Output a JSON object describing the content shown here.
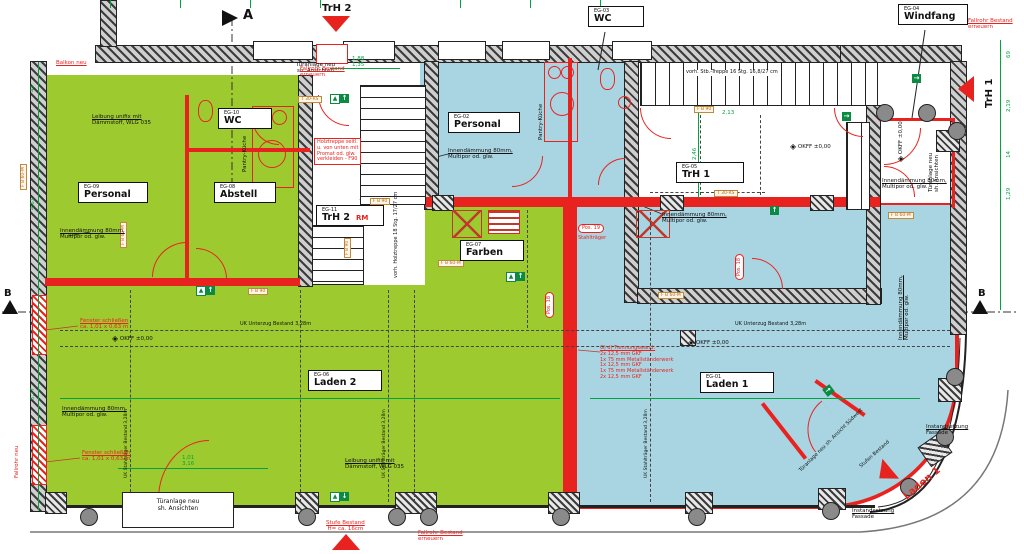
{
  "colors": {
    "green_room": "#9dcb2f",
    "blue_room": "#a9d5e2",
    "new_red": "#e8231f",
    "dim_green": "#00a33d",
    "wall_gray": "#3c3c3c",
    "fire_orange": "#c08a3e",
    "exit_green": "#0a8a43"
  },
  "section": {
    "a": "A",
    "b_left": "B",
    "b_right": "B"
  },
  "arrows": {
    "trh2": "TrH 2",
    "trh1": "TrH 1",
    "laden1": "Laden 1"
  },
  "rooms": {
    "personal_eg09": {
      "id": "EG-09",
      "name": "Personal"
    },
    "wc_eg10": {
      "id": "EG-10",
      "name": "WC"
    },
    "abstell_eg08": {
      "id": "EG-08",
      "name": "Abstell"
    },
    "trh2_eg11": {
      "id": "EG-11",
      "name": "TrH 2",
      "suffix": "RM"
    },
    "personal_eg02": {
      "id": "EG-02",
      "name": "Personal"
    },
    "wc_eg03": {
      "id": "EG-03",
      "name": "WC"
    },
    "windfang_eg04": {
      "id": "EG-04",
      "name": "Windfang"
    },
    "trh1_eg05": {
      "id": "EG-05",
      "name": "TrH 1"
    },
    "farben_eg07": {
      "id": "EG-07",
      "name": "Farben"
    },
    "laden2_eg06": {
      "id": "EG-06",
      "name": "Laden 2"
    },
    "laden1_eg01": {
      "id": "EG-01",
      "name": "Laden 1"
    }
  },
  "ann": {
    "innend": "Innendämmung 80mm,",
    "innend2": "Multipor od. glw.",
    "leibung": "Leibung unifix mit",
    "leibung2": "Dämmstoff, WLG 035",
    "balkon": "Balkon neu",
    "fallrohr": "Fallrohr Bestand",
    "fallrohr2": "erneuern",
    "fallrohr_neu": "Fallrohr neu",
    "fenster": "Fenster schließen",
    "fenster2": "ca. 1,01 x 0,63 m",
    "holz1": "Holztreppe seitl.",
    "holz2": "u. von unten mit",
    "holz3": "Promat od. glw.",
    "holz4": "verkleiden - F90",
    "tuer1": "Türanlage neu",
    "tuer2": "sh. Ansichten",
    "stufe1": "Stufe Bestand",
    "stufe2": "H= ca. 16cm",
    "stb_treppe": "vorh. Stb.-Treppe 16 Stg. 16,8/27 cm",
    "holztreppe_vorh": "vorh. Holztreppe 18 Stg. 17/27 cm",
    "pantry": "Pantry-Küche",
    "okff": "OKFF ±0,00",
    "pos18": "Pos. 18",
    "pos19": "Pos. 19",
    "stahltraeger": "Stahlträger",
    "tw0": "G) d) Trennungswand:",
    "tw1": "2x 12,5 mm GKF",
    "tw2": "1x 75 mm Metallständerwerk",
    "tw3": "1x 12,5 mm GKF",
    "tw4": "1x 75 mm Metallständerwerk",
    "tw5": "2x 12,5 mm GKF",
    "instand1": "Instandsetzung",
    "instand2": "Fassade",
    "tuer_sw": "Türanlage neu sh. Ansicht Südwest",
    "stufen_bestand": "Stufen Bestand",
    "unterzug": "UK Unterzug Bestand 3,28m",
    "stahl_dash": "UK Stahlträger Bestand 3,28m"
  },
  "fire": {
    "fb90": "F B 90",
    "fb60": "F B 60-M",
    "t30": "T 30-RS"
  },
  "dims": {
    "d47": "47",
    "d461": "4,61",
    "d577": "5,77",
    "d69": "69",
    "d188": "1,88",
    "d135": "1,35",
    "d219": "2,19",
    "d14": "14",
    "d129": "1,29",
    "d246": "2,46",
    "d213": "2,13",
    "d101": "1,01",
    "d316": "3,16"
  },
  "icons": {
    "up": "↑",
    "down": "↓",
    "left": "←",
    "right": "→",
    "diamond": "◈",
    "run": "▲"
  }
}
